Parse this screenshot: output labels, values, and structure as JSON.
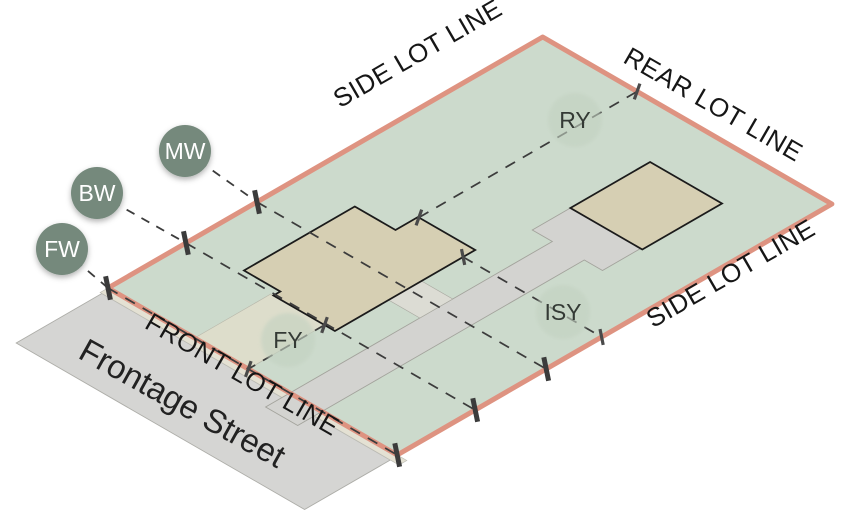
{
  "street": {
    "name": "Frontage Street"
  },
  "lot_lines": {
    "front": "FRONT LOT LINE",
    "rear": "REAR LOT LINE",
    "side_upper": "SIDE LOT LINE",
    "side_lower": "SIDE LOT LINE"
  },
  "markers": {
    "mw": {
      "label": "MW"
    },
    "bw": {
      "label": "BW"
    },
    "fw": {
      "label": "FW"
    },
    "ry": {
      "label": "RY"
    },
    "fy": {
      "label": "FY"
    },
    "isy": {
      "label": "ISY"
    }
  },
  "colors": {
    "lot_fill": "#ccdacc",
    "lot_border": "#de9381",
    "building_fill": "#d6cfb3",
    "building_outline": "#1b1b1b",
    "street_fill": "#d5d5d3",
    "sidewalk_fill": "#e4e1d3",
    "driveway_fill": "#d3d3d0",
    "walkway_fill": "#e1decb",
    "badge_fill": "#74897b",
    "badge_text": "#ffffff",
    "yard_circle_fill": "#c3d2c1",
    "yard_text": "#343a35",
    "dash_color": "#3c3c3c",
    "label_color": "#161616"
  }
}
